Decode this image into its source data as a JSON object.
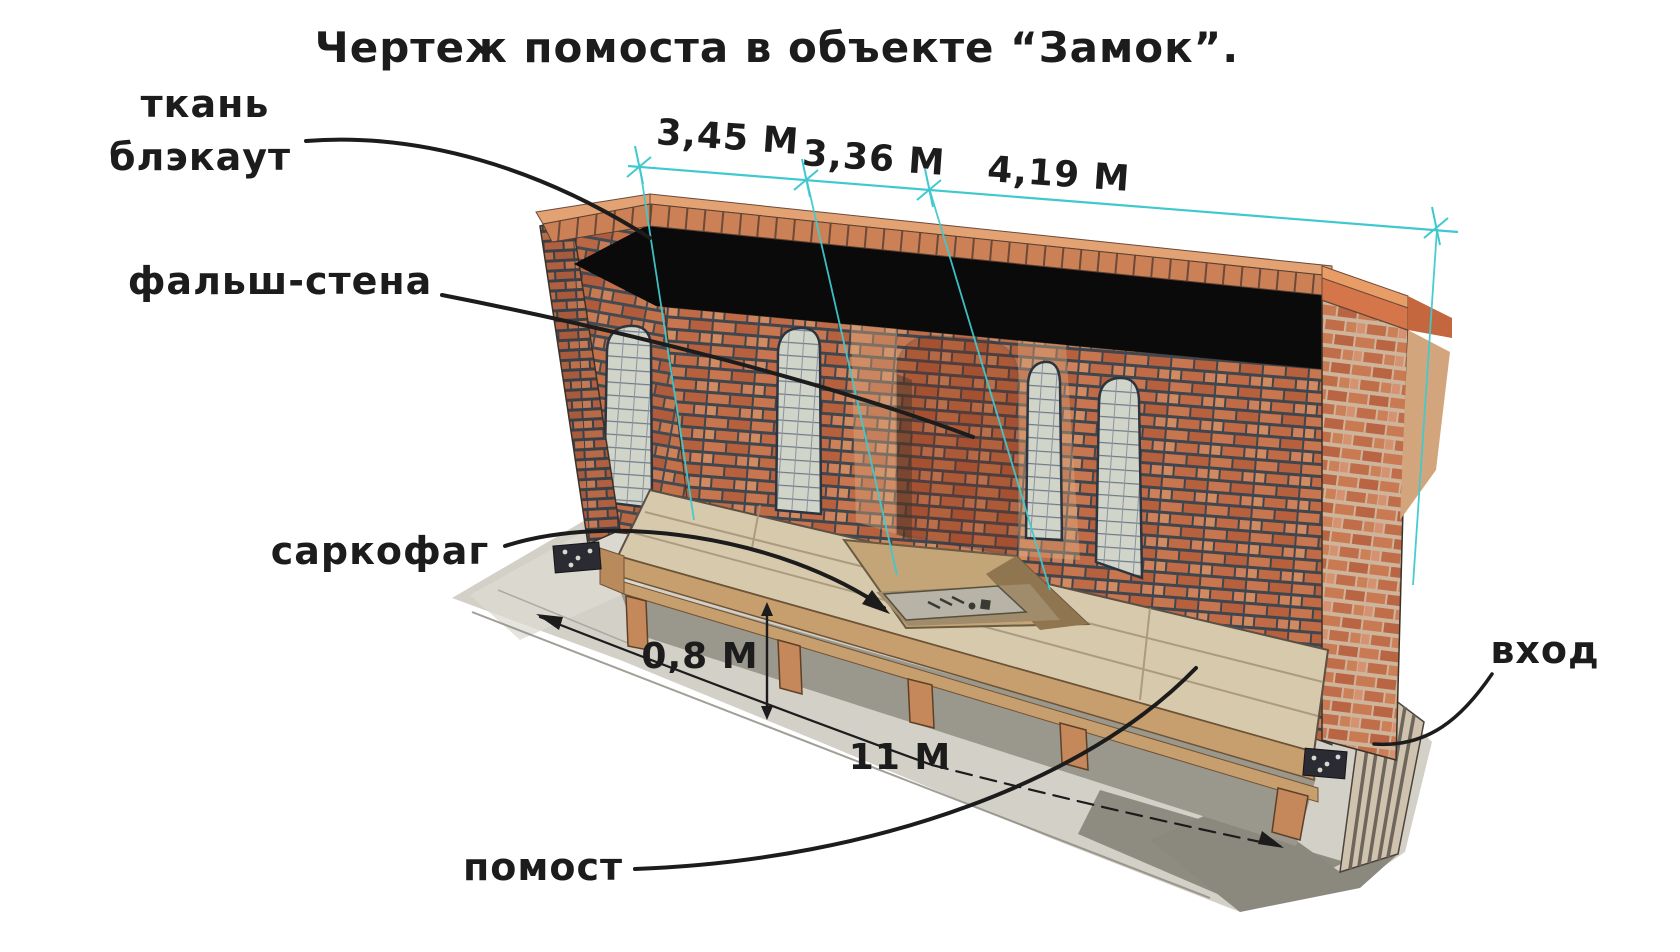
{
  "title": "Чертеж помоста в объекте “Замок”.",
  "labels": {
    "fabric_line1": "ткань",
    "fabric_line2": "блэкаут",
    "false_wall": "фальш-стена",
    "sarcophagus": "саркофаг",
    "platform": "помост",
    "entrance": "вход"
  },
  "dimensions": {
    "top_left": "3,45 М",
    "top_middle": "3,36 М",
    "top_right": "4,19 М",
    "platform_height": "0,8 М",
    "platform_length": "11 М"
  },
  "colors": {
    "dimension_line": "#3fc9cf",
    "annotation_ink": "#1c1c1c",
    "blackout_fabric": "#0a0a0a",
    "brick": "#c0714c",
    "mortar": "#3f464e",
    "rim_brick": "#cc8055",
    "deck_wood": "#d7c9ab",
    "leg_wood": "#c5885a",
    "floor_concrete": "#d3d0c8",
    "entrance_ramp": "#cfc3af",
    "pit_wood": "#c3a577",
    "sarcophagus_slab": "#b7b4a7"
  }
}
